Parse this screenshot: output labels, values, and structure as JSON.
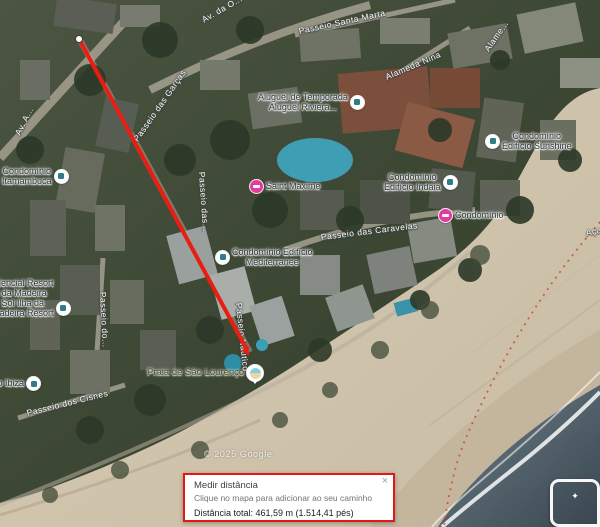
{
  "map": {
    "attribution": "© 2025 Google",
    "labels": [
      {
        "name": "street-av-da-o",
        "kind": "street",
        "lines": [
          "Av. da O..."
        ],
        "x": 203,
        "y": 16,
        "rot": -30,
        "interactable": false
      },
      {
        "name": "street-passeio-santa-marta",
        "kind": "street",
        "lines": [
          "Passeio Santa Marta"
        ],
        "x": 299,
        "y": 27,
        "rot": -12,
        "interactable": false
      },
      {
        "name": "street-alameda-nina",
        "kind": "street",
        "lines": [
          "Alameda Nina"
        ],
        "x": 386,
        "y": 73,
        "rot": -23,
        "interactable": false
      },
      {
        "name": "street-alameda-fragment",
        "kind": "street",
        "lines": [
          "Alame..."
        ],
        "x": 487,
        "y": 46,
        "rot": -55,
        "interactable": false
      },
      {
        "name": "street-av-a-fragment",
        "kind": "street",
        "lines": [
          "Av. A..."
        ],
        "x": 18,
        "y": 130,
        "rot": -63,
        "interactable": false
      },
      {
        "name": "street-passeio-das-garcas",
        "kind": "street",
        "lines": [
          "Passeio das Garças"
        ],
        "x": 136,
        "y": 136,
        "rot": -55,
        "interactable": false
      },
      {
        "name": "street-passeio-das-vertical",
        "kind": "street",
        "lines": [
          "Passeio das..."
        ],
        "x": 201,
        "y": 167,
        "rot": 86,
        "interactable": false
      },
      {
        "name": "street-passeio-das-caravelas",
        "kind": "street",
        "lines": [
          "Passeio das Caravelas"
        ],
        "x": 321,
        "y": 233,
        "rot": -7,
        "interactable": false
      },
      {
        "name": "street-passeio-do-vertical",
        "kind": "street",
        "lines": [
          "Passeio do..."
        ],
        "x": 102,
        "y": 287,
        "rot": 87,
        "interactable": false
      },
      {
        "name": "street-passeio-nautico",
        "kind": "street",
        "lines": [
          "Passeio Náutico"
        ],
        "x": 238,
        "y": 298,
        "rot": 84,
        "interactable": false
      },
      {
        "name": "street-passeio-dos-cisnes",
        "kind": "street",
        "lines": [
          "Passeio dos Cisnes"
        ],
        "x": 27,
        "y": 409,
        "rot": -14,
        "interactable": false
      },
      {
        "name": "street-acai",
        "kind": "street",
        "lines": [
          "Açaí..."
        ],
        "x": 586,
        "y": 229,
        "rot": -12,
        "interactable": false
      },
      {
        "name": "poi-aluguel-de-temporada",
        "kind": "poi",
        "lines": [
          "Aluguel de Temporada",
          "Aluguel Riviera..."
        ],
        "x": 258,
        "y": 92,
        "rot": 0,
        "icon": "building",
        "icon_side": "right",
        "interactable": true
      },
      {
        "name": "poi-saint-maxime",
        "kind": "poi",
        "lines": [
          "Saint Maxime"
        ],
        "x": 250,
        "y": 180,
        "rot": 0,
        "icon": "lodging",
        "icon_side": "left",
        "interactable": true
      },
      {
        "name": "poi-condominio-edificio-indaia",
        "kind": "poi",
        "lines": [
          "Condomínio",
          "Edifício Indaiá"
        ],
        "x": 384,
        "y": 172,
        "rot": 0,
        "icon": "building",
        "icon_side": "right",
        "interactable": true
      },
      {
        "name": "poi-condominio-lodging",
        "kind": "poi",
        "lines": [
          "Condomínio"
        ],
        "x": 439,
        "y": 209,
        "rot": 0,
        "icon": "lodging",
        "icon_side": "left",
        "interactable": true
      },
      {
        "name": "poi-condominio-edificio-sunshine",
        "kind": "poi",
        "lines": [
          "Condomínio",
          "Edifício Sunshine"
        ],
        "x": 486,
        "y": 131,
        "rot": 0,
        "icon": "building",
        "icon_side": "left",
        "interactable": true
      },
      {
        "name": "poi-condominio-itamambuca",
        "kind": "poi",
        "lines": [
          "Condomínio",
          "Itamambuca"
        ],
        "x": 2,
        "y": 166,
        "rot": 0,
        "icon": "building",
        "icon_side": "right",
        "interactable": true
      },
      {
        "name": "poi-condominio-edificio-mediterranee",
        "kind": "poi",
        "lines": [
          "Condomínio Edifício",
          "Mediterranee"
        ],
        "x": 216,
        "y": 247,
        "rot": 0,
        "icon": "building",
        "icon_side": "left",
        "interactable": true
      },
      {
        "name": "poi-residencial-resort-ilha-da-madeira",
        "kind": "poi",
        "lines": [
          "Residencial Resort",
          "Ilha da Madeira"
        ],
        "x": -22,
        "y": 278,
        "rot": 0,
        "interactable": true
      },
      {
        "name": "poi-sol-ilha-da-madeira-resort",
        "kind": "poi",
        "lines": [
          "Sol Ilha da",
          "Madeira Resort"
        ],
        "x": -8,
        "y": 298,
        "rot": 0,
        "icon": "building",
        "icon_side": "right",
        "interactable": true
      },
      {
        "name": "poi-condominio-ibiza",
        "kind": "poi",
        "lines": [
          "Condomínio Ibiza"
        ],
        "x": -46,
        "y": 377,
        "rot": 0,
        "icon": "building",
        "icon_side": "right",
        "interactable": true
      },
      {
        "name": "poi-praia-de-sao-lourenco",
        "kind": "beach",
        "lines": [
          "Praia de São Lourenço"
        ],
        "x": 147,
        "y": 365,
        "rot": 0,
        "icon": "beach",
        "icon_side": "right",
        "interactable": true
      }
    ]
  },
  "measure_dialog": {
    "title": "Medir distância",
    "hint": "Clique no mapa para adicionar ao seu caminho",
    "total": "Distância total: 461,59 m (1.514,41 pés)",
    "close": "×"
  },
  "icons": {
    "photo_preview": "✦"
  }
}
